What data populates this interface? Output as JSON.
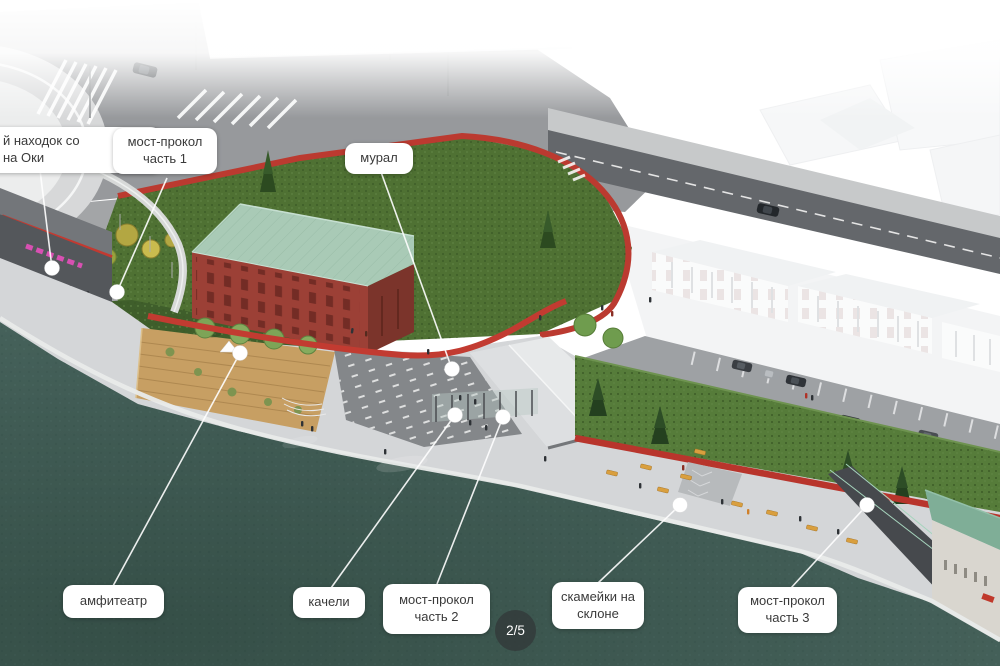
{
  "callouts": {
    "finds": "й находок со\nна Оки",
    "bridge1": "мост-прокол\nчасть 1",
    "mural": "мурал",
    "amphitheater": "амфитеатр",
    "swings": "качели",
    "bridge2": "мост-прокол\nчасть 2",
    "benches": "скамейки на\nсклоне",
    "bridge3": "мост-прокол\nчасть 3"
  },
  "pagination": {
    "current_page": "2/5"
  },
  "colors": {
    "water": "#45615A",
    "meadow_green": "#4F7133",
    "hedge_green": "#567C3A",
    "brick_red": "#9C4036",
    "roof_mint": "#A9CAB6",
    "path_red": "#BB3A30",
    "promenade_gray": "#D4D6D8",
    "road_gray": "#97999C",
    "deck_wood": "#C79F63",
    "callout_bg": "#FFFFFF",
    "callout_text": "#3A3A3A"
  }
}
